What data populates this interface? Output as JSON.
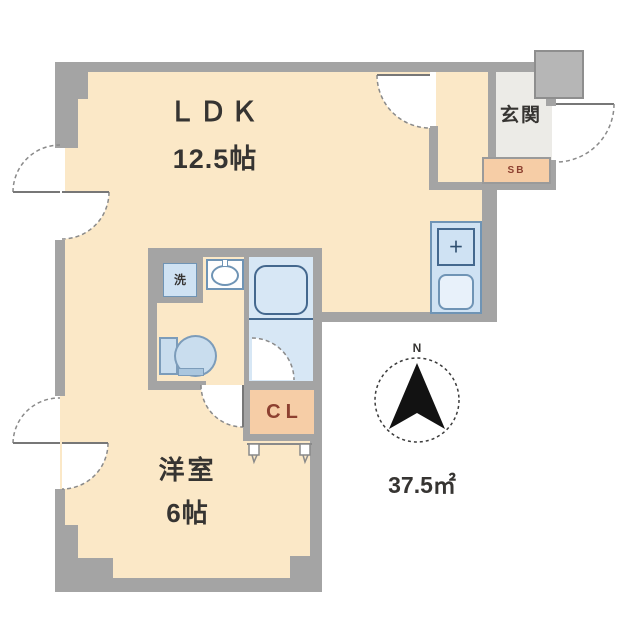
{
  "plan": {
    "rooms": {
      "ldk": {
        "label": "ＬＤＫ",
        "size": "12.5帖"
      },
      "western_room": {
        "label": "洋室",
        "size": "6帖"
      },
      "entrance": {
        "label": "玄関"
      },
      "shoe_box": {
        "label": "SB"
      },
      "closet": {
        "label": "CL"
      },
      "laundry": {
        "label": "洗"
      }
    },
    "fixtures": {
      "stove_symbol": "＋"
    },
    "total_area": "37.5㎡",
    "compass": {
      "north_label": "N"
    },
    "colors": {
      "floor_cream": "#fbe8c7",
      "wall_gray": "#a4a4a4",
      "entrance_floor": "#ecebe7",
      "fixture_blue_fill": "#cfe2f3",
      "fixture_blue_border": "#6f94b5",
      "bath_floor": "#d7e7f5",
      "storage_orange": "#f6cda6",
      "storage_text_red": "#8d4030",
      "text_dark": "#363432"
    }
  }
}
